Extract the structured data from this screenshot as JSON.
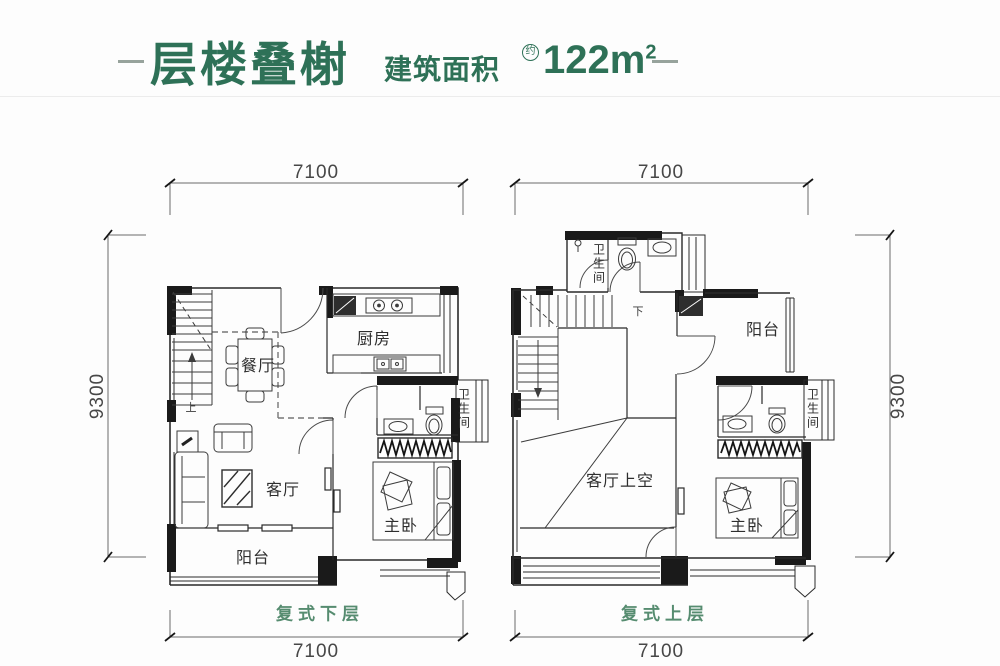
{
  "title": {
    "main": "层楼叠榭",
    "subtitle": "建筑面积",
    "approx": "约",
    "area_value": "122m",
    "area_sup": "2"
  },
  "colors": {
    "title-green": "#2e7157",
    "floor-label-green": "#568c70",
    "dim-gray": "#474747",
    "wall-dark": "#1a1a1a"
  },
  "plans": {
    "lower": {
      "floor_label": "复式下层",
      "dims": {
        "top": "7100",
        "bottom": "7100",
        "side": "9300"
      },
      "rooms": {
        "dining": "餐厅",
        "kitchen": "厨房",
        "bath": "卫生间",
        "living": "客厅",
        "master": "主卧",
        "balcony": "阳台"
      },
      "stair_mark": "上"
    },
    "upper": {
      "floor_label": "复式上层",
      "dims": {
        "top": "7100",
        "bottom": "7100",
        "side": "9300"
      },
      "rooms": {
        "bath_top": "卫生间",
        "balcony": "阳台",
        "void": "客厅上空",
        "master": "主卧",
        "bath": "卫生间"
      },
      "stair_mark": "下"
    }
  }
}
